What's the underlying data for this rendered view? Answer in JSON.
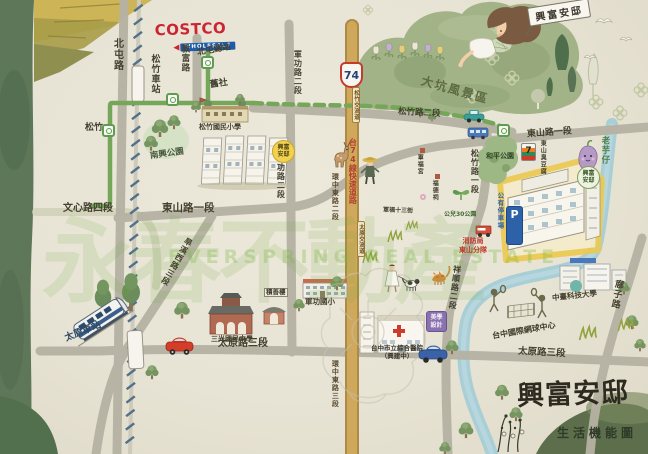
{
  "project": {
    "name": "興富安邸",
    "subtitle": "生活機能圖",
    "ribbon": "興富安邸"
  },
  "watermark": {
    "cjk": "永春不動產",
    "en": "EVERSPRING REAL ESTATE"
  },
  "brands": {
    "costco": "COSTCO",
    "costco_sub": "WHOLESALE",
    "seven": "7",
    "parking_p": "P"
  },
  "highway": {
    "shield": "74",
    "name": "台74線快速道路",
    "ic_north": "松竹交流道",
    "ic_south": "太原交流道"
  },
  "roads": {
    "beitun": "北屯路",
    "dunfu": "敦富路",
    "junggong2_a": "軍功路二段",
    "junggong2_b": "軍功路二段",
    "songzhu2": "松竹路二段",
    "songzhu1": "松竹路一段",
    "xiangshun2": "祥順路二段",
    "buzi": "廍子路",
    "dongshan1_a": "東山路一段",
    "dongshan1_b": "東山路一段",
    "wenxin4": "文心路四段",
    "taiyuan3_a": "太原路三段",
    "taiyuan3_b": "太原路三段",
    "hanxi3": "旱溪西路三段",
    "huanzhong2": "環中東路二段",
    "huanzhong3": "環中東路三段",
    "junfu13": "軍福十三街"
  },
  "transit": {
    "songzhu_station": "松竹車站",
    "taiyuan_station": "太原車站",
    "beitun_terminal": "北屯總站",
    "jiushe": "舊社",
    "songzhu_metro": "松竹"
  },
  "places": {
    "dakeng": "大坑風景區",
    "nanxing_park": "南興公園",
    "heping_park": "和平公園",
    "gonger30": "公兒30公園",
    "songzhu_elem": "松竹國民小學",
    "junggong_elem": "軍功國小",
    "sanguang_jr": "三光國民中學",
    "zhongtai_univ": "中臺科技大學",
    "hospital_1": "台中市立綜合醫院",
    "hospital_2": "（興建中）",
    "design": "美學設計",
    "fire_1": "消防局",
    "fire_2": "東山分隊",
    "parking_lot": "公有停車場",
    "tennis": "台中國際網球中心",
    "jishan_lou": "積善樓",
    "laoyuzai": "老芋仔",
    "stinky_tofu": "東山臭豆腐",
    "junfu_temple": "軍福宮",
    "fude_temple": "福德祠",
    "bubble_left": "興富安邸",
    "bubble_right": "興富安邸"
  }
}
